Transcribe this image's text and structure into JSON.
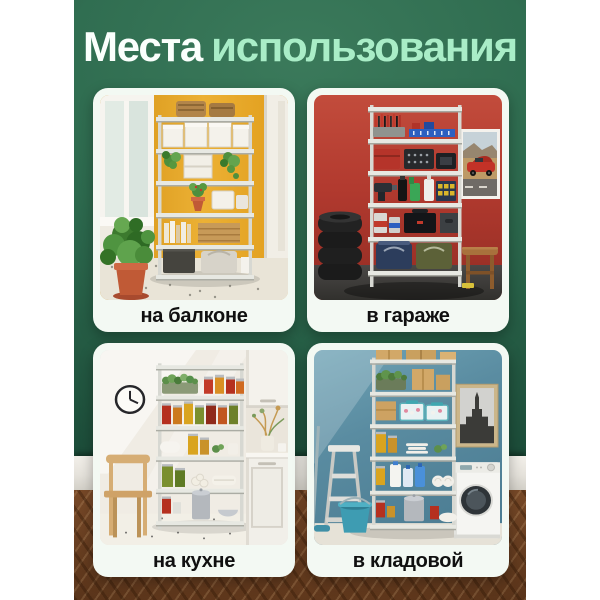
{
  "theme": {
    "colors": {
      "canvas": "#ffffff",
      "wall-green": "#2d6a4e",
      "wall-green-dark": "#1c4c39",
      "wall-green-light": "#3b7a5b",
      "title-white": "#fafffc",
      "title-mint": "#a9edc7",
      "card-bg": "#f3f9f3",
      "label-color": "#101010",
      "floor-wood": "#8a5630"
    }
  },
  "title": {
    "full": "Места использования",
    "part1": "Места",
    "part2": "использования"
  },
  "cards": [
    {
      "id": "balcony",
      "label": "на балконе"
    },
    {
      "id": "garage",
      "label": "в гараже"
    },
    {
      "id": "kitchen",
      "label": "на кухне"
    },
    {
      "id": "pantry",
      "label": "в кладовой"
    }
  ]
}
